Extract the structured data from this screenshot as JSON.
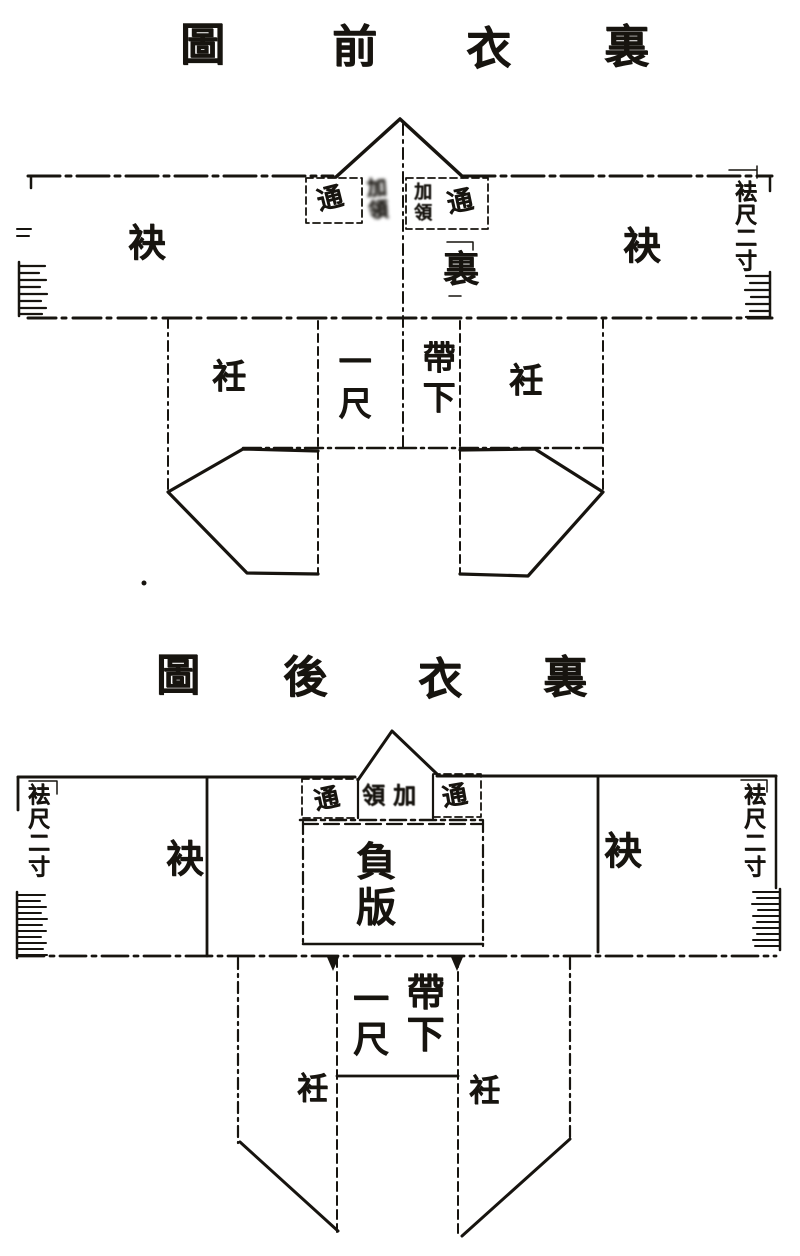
{
  "colors": {
    "ink": "#17140f",
    "paper": "#ffffff"
  },
  "front": {
    "title": [
      "圖",
      "前",
      "衣",
      "裏"
    ],
    "collar": {
      "tong_left": "通",
      "stack_left": "加領",
      "stack_right": "加領",
      "tong_right": "通"
    },
    "sleeve_left": "袂",
    "sleeve_right": "袂",
    "lining": "裏",
    "cuff_right": "袪尺二寸",
    "lapel_left": "衽",
    "lapel_right": "衽",
    "one_chi": "一尺",
    "below_belt": "帶下"
  },
  "back": {
    "title": [
      "圖",
      "後",
      "衣",
      "裏"
    ],
    "collar": {
      "tong_left": "通",
      "center": "領加",
      "tong_right": "通"
    },
    "cuff_left": "袪尺二寸",
    "cuff_right": "袪尺二寸",
    "sleeve_left": "袂",
    "sleeve_right": "袂",
    "back_panel": "負版",
    "one_chi": "一尺",
    "below_belt": "帶下",
    "lapel_left": "衽",
    "lapel_right": "衽"
  }
}
